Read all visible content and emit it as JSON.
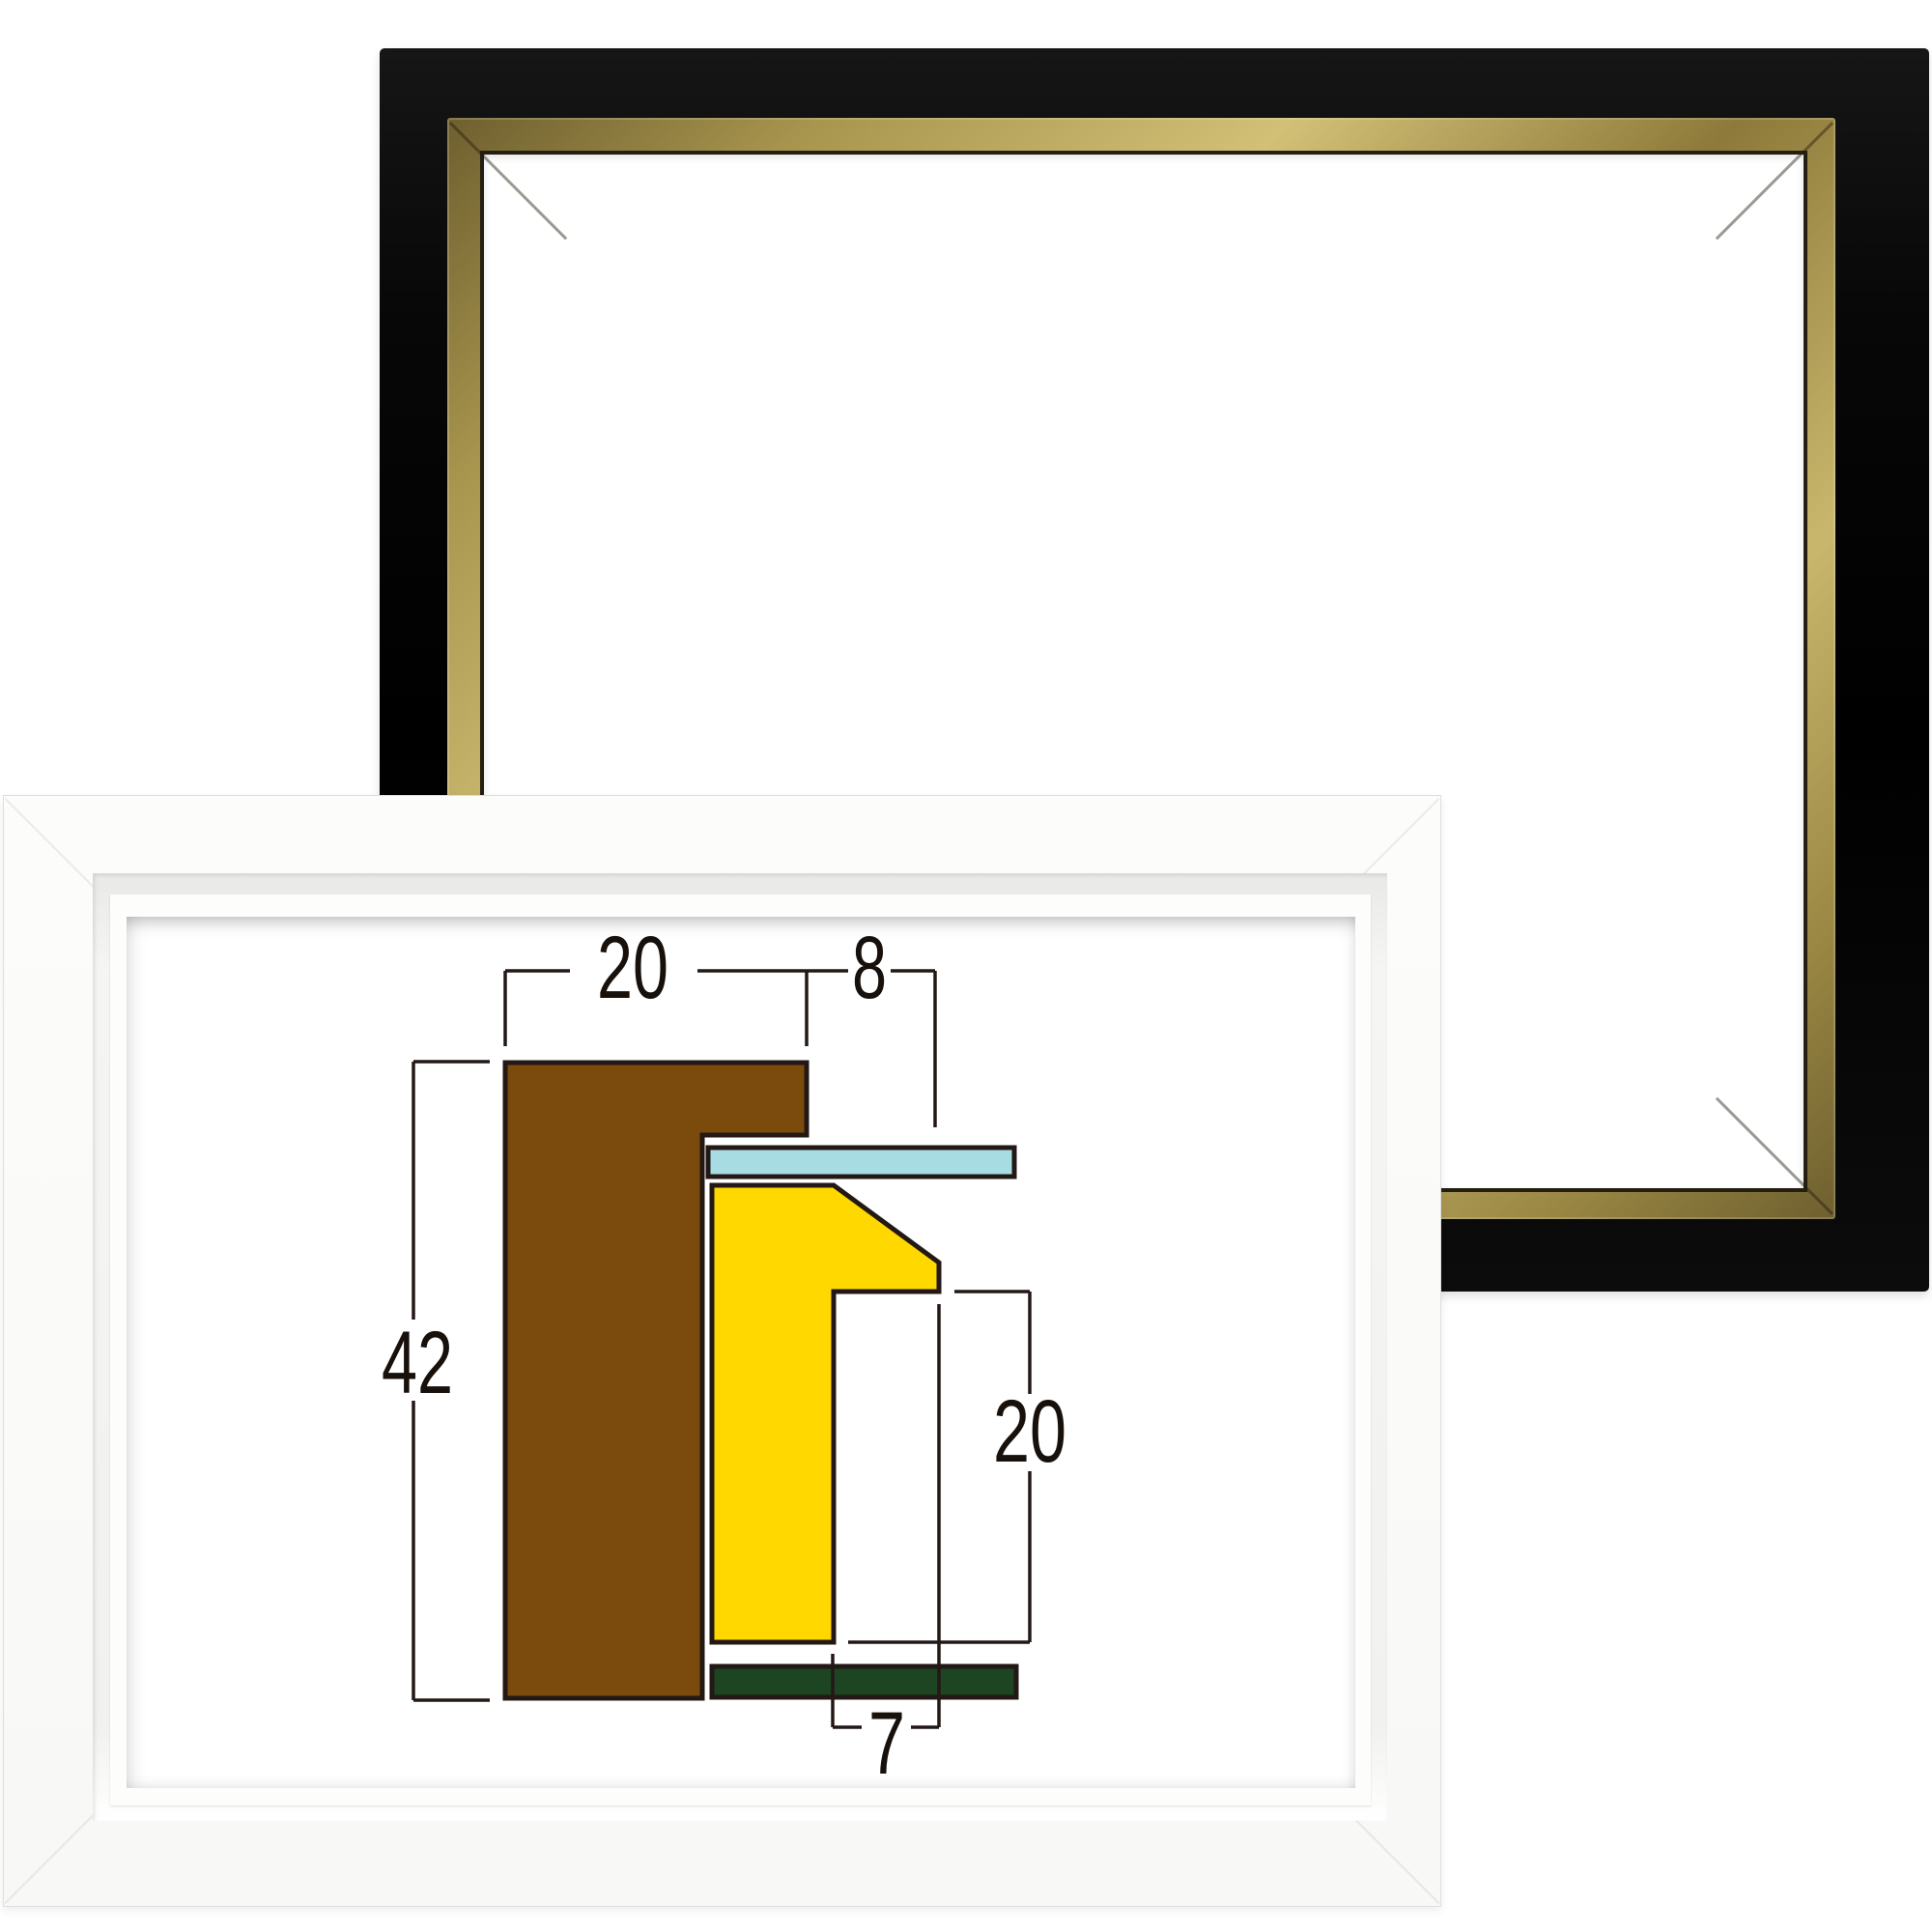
{
  "scene": {
    "background": "#ffffff"
  },
  "black_frame": {
    "body_color": "#0a0a0a",
    "gold_trim_color": "#b7a45c",
    "opening_color": "#ffffff"
  },
  "white_frame": {
    "body_color": "#fbfbf9",
    "opening_color": "#ffffff"
  },
  "diagram": {
    "outline_color": "#231815",
    "colors": {
      "brown": "#7a4b0c",
      "cyan": "#a7dce2",
      "yellow": "#ffd800",
      "green": "#1d4522"
    },
    "labels": {
      "top_left": "20",
      "top_right": "8",
      "left": "42",
      "right": "20",
      "bottom": "7"
    }
  }
}
